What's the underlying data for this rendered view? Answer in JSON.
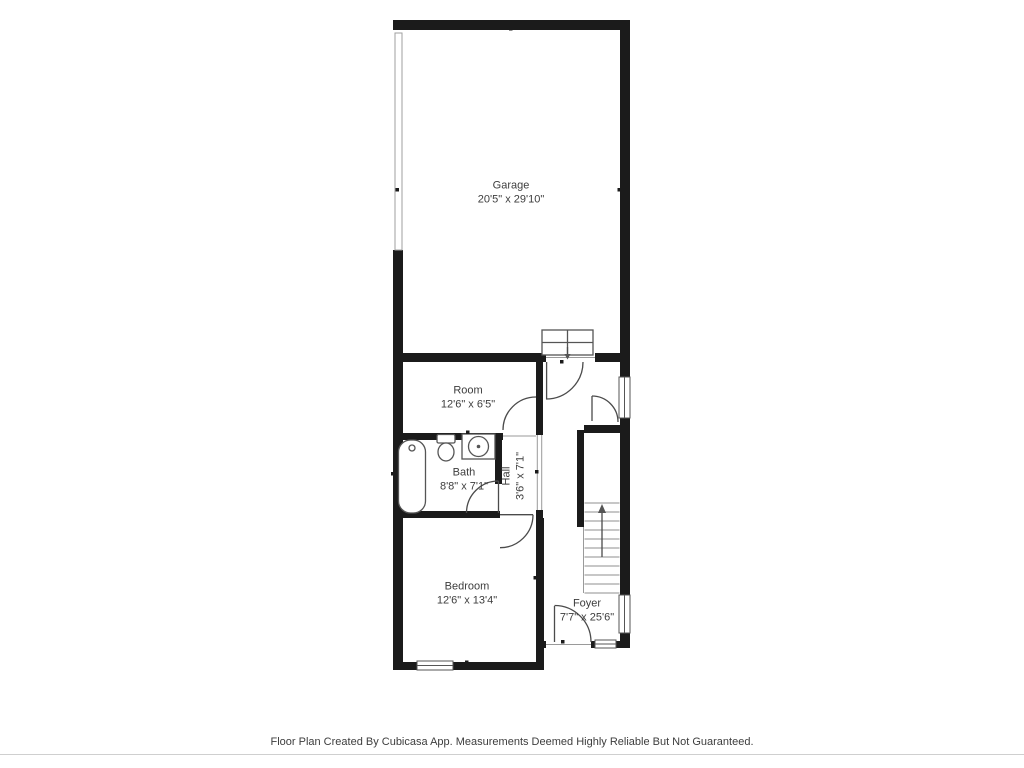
{
  "rooms": {
    "garage": {
      "name": "Garage",
      "dims": "20'5\" x 29'10\""
    },
    "room": {
      "name": "Room",
      "dims": "12'6\" x 6'5\""
    },
    "bath": {
      "name": "Bath",
      "dims": "8'8\" x 7'1\""
    },
    "hall": {
      "name": "Hall",
      "dims": "3'6\" x 7'1\""
    },
    "bedroom": {
      "name": "Bedroom",
      "dims": "12'6\" x 13'4\""
    },
    "foyer": {
      "name": "Foyer",
      "dims": "7'7\" x 25'6\""
    }
  },
  "footer": {
    "text": "Floor Plan Created By Cubicasa App. Measurements Deemed Highly Reliable But Not Guaranteed."
  },
  "symbols": {
    "stairs": "stairs-up-arrow",
    "entry_steps": "garage-entry-steps-down-arrow",
    "fixtures": [
      "bathtub",
      "toilet",
      "sink"
    ],
    "windows": 4,
    "doors": 6,
    "garage_door": "garage-door-left-wall"
  },
  "colors": {
    "wall": "#1b1b1b",
    "line": "#4b4b4b",
    "thin": "#9a9a9a",
    "fixture": "#555555",
    "garage_door": "#9f9f9f",
    "text": "#3d3d3d"
  }
}
